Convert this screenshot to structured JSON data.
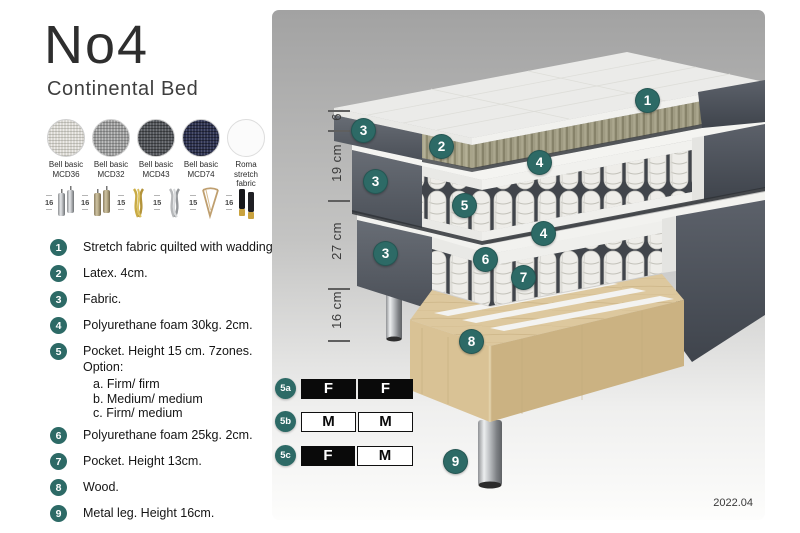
{
  "header": {
    "title": "No4",
    "subtitle": "Continental Bed"
  },
  "fabrics": [
    {
      "name": "Bell basic",
      "code": "MCD36",
      "color": "#d8d6d0"
    },
    {
      "name": "Bell basic",
      "code": "MCD32",
      "color": "#9b9c9c"
    },
    {
      "name": "Bell basic",
      "code": "MCD43",
      "color": "#53565b"
    },
    {
      "name": "Bell basic",
      "code": "MCD74",
      "color": "#2f3452"
    },
    {
      "name": "Roma",
      "code": "stretch fabric",
      "color": "#fbfbfb"
    }
  ],
  "legs": [
    {
      "height": "16",
      "style": "cylinder-silver"
    },
    {
      "height": "16",
      "style": "cylinder-brass"
    },
    {
      "height": "15",
      "style": "twist-gold"
    },
    {
      "height": "15",
      "style": "twist-silver"
    },
    {
      "height": "15",
      "style": "hairpin"
    },
    {
      "height": "16",
      "style": "cylinder-black-gold"
    }
  ],
  "spec_list": [
    {
      "num": "1",
      "text": "Stretch fabric quilted with wadding."
    },
    {
      "num": "2",
      "text": "Latex. 4cm."
    },
    {
      "num": "3",
      "text": "Fabric."
    },
    {
      "num": "4",
      "text": "Polyurethane foam 30kg. 2cm."
    },
    {
      "num": "5",
      "text": "Pocket. Height 15 cm. 7zones. Option:",
      "options": [
        "a. Firm/ firm",
        "b. Medium/ medium",
        "c. Firm/ medium"
      ]
    },
    {
      "num": "6",
      "text": "Polyurethane foam 25kg. 2cm."
    },
    {
      "num": "7",
      "text": "Pocket. Height 13cm."
    },
    {
      "num": "8",
      "text": "Wood."
    },
    {
      "num": "9",
      "text": "Metal leg. Height 16cm."
    }
  ],
  "dimensions": [
    "6",
    "19 cm",
    "27 cm",
    "16 cm"
  ],
  "diagram": {
    "badges": [
      "1",
      "2",
      "3",
      "4",
      "5",
      "6",
      "7",
      "8",
      "9"
    ]
  },
  "firmness_options": [
    {
      "label": "5a",
      "left": {
        "text": "F",
        "fill": "black"
      },
      "right": {
        "text": "F",
        "fill": "black"
      }
    },
    {
      "label": "5b",
      "left": {
        "text": "M",
        "fill": "white"
      },
      "right": {
        "text": "M",
        "fill": "white"
      }
    },
    {
      "label": "5c",
      "left": {
        "text": "F",
        "fill": "black"
      },
      "right": {
        "text": "M",
        "fill": "white"
      }
    }
  ],
  "version": "2022.04",
  "colors": {
    "badge_teal": "#2d6a66",
    "upholstery": "#50555d",
    "latex": "#a8a48a",
    "wood": "#ddc89e",
    "background_top": "#a2a2a2"
  }
}
